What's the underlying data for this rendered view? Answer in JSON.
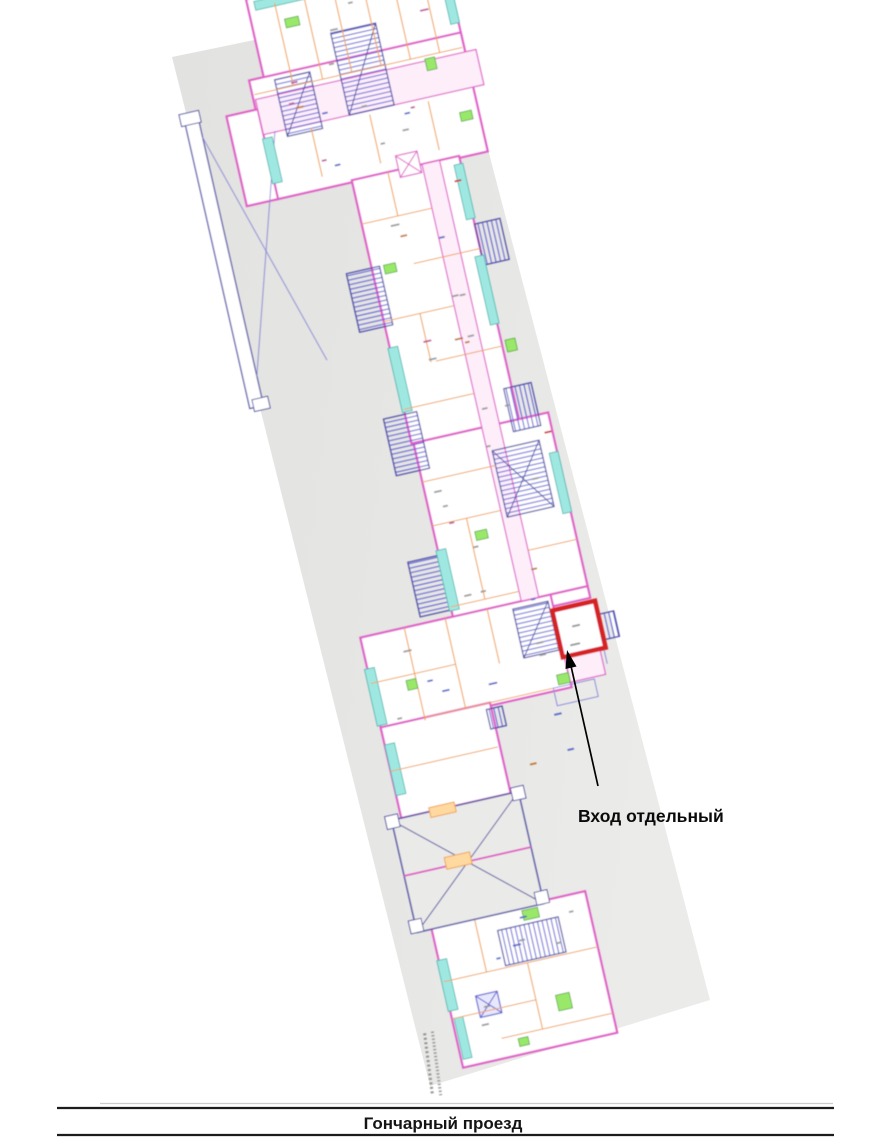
{
  "scan": {
    "kind": "floor-plan-scan",
    "paper_color": "#e5e5e3",
    "rotation_deg": -12.8,
    "palette": {
      "wall_magenta": "#e060c8",
      "wall_fill_pink": "#fdeefa",
      "partition_orange": "#f0a03c",
      "balcony_cyan": "#9fe8e2",
      "balcony_cyan_border": "#2fa8a0",
      "stair_hatch_blue": "#5a5ad2",
      "outline_navy": "#4848a2",
      "fixture_green": "#9ae86a",
      "fixture_green_border": "#3f9f30"
    }
  },
  "highlight": {
    "shape": "rectangle",
    "color": "#d62020"
  },
  "annotation": {
    "entrance_label": "Вход отдельный",
    "arrow_color": "#000000",
    "text_color": "#0a0a0a"
  },
  "street": {
    "label": "Гончарный проезд",
    "line_color": "#1c1c1c",
    "text_color": "#141414"
  }
}
